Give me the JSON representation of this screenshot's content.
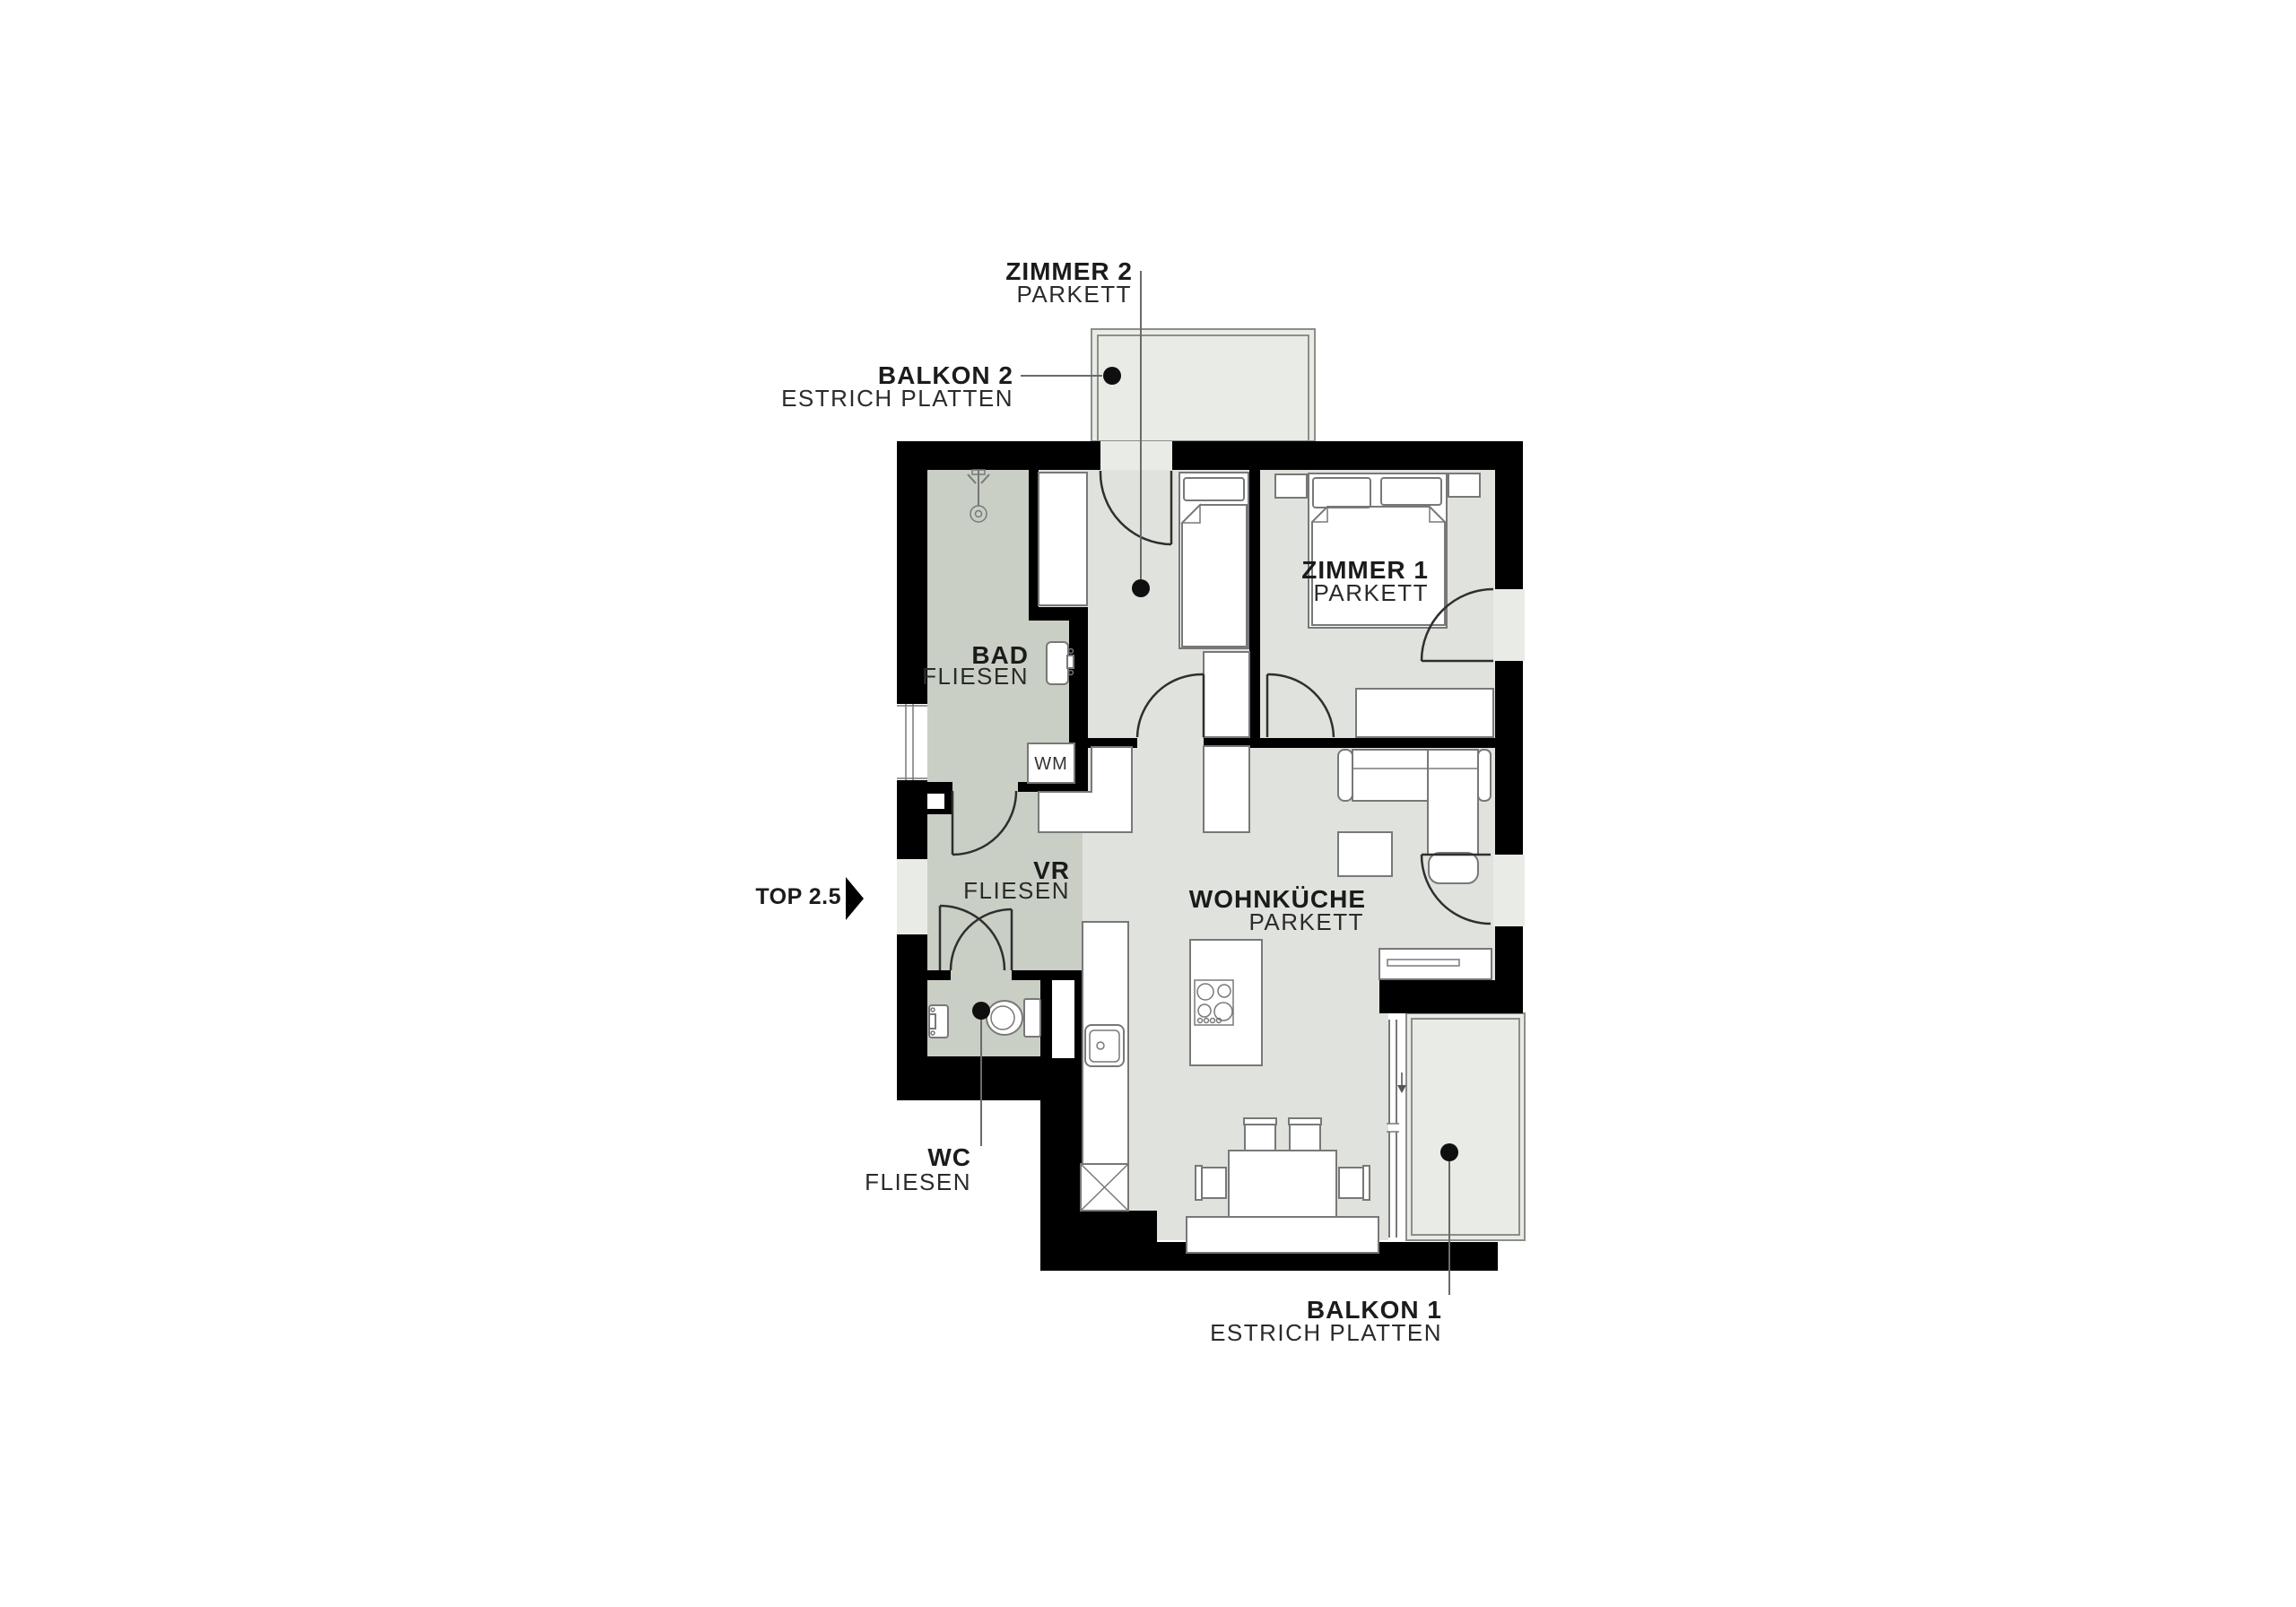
{
  "colors": {
    "wall": "#000000",
    "parkett_floor": "#e0e3dd",
    "tile_floor": "#c9cfc5",
    "balcony_floor": "#e9ebe6",
    "background": "#ffffff",
    "text": "#1b1b1b"
  },
  "unit": {
    "label": "TOP 2.5"
  },
  "labels": {
    "zimmer2": {
      "name": "ZIMMER 2",
      "floor": "PARKETT"
    },
    "balkon2": {
      "name": "BALKON 2",
      "floor": "ESTRICH PLATTEN"
    },
    "zimmer1": {
      "name": "ZIMMER 1",
      "floor": "PARKETT"
    },
    "bad": {
      "name": "BAD",
      "floor": "FLIESEN"
    },
    "vr": {
      "name": "VR",
      "floor": "FLIESEN"
    },
    "wohnkueche": {
      "name": "WOHNKÜCHE",
      "floor": "PARKETT"
    },
    "wc": {
      "name": "WC",
      "floor": "FLIESEN"
    },
    "balkon1": {
      "name": "BALKON 1",
      "floor": "ESTRICH PLATTEN"
    }
  },
  "appliances": {
    "washing_machine": "WM"
  }
}
